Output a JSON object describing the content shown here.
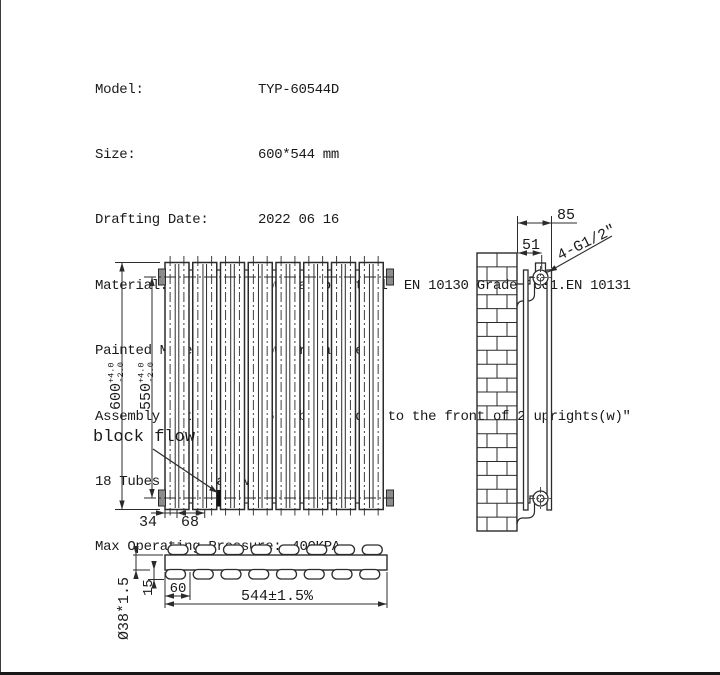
{
  "page": {
    "background": "#ffffff",
    "line_color": "#2b2b2b",
    "boss_color": "#8c8c8c",
    "plug_color": "#111111"
  },
  "specs": {
    "rows": [
      {
        "label": "Model:",
        "value": "TYP-60544D"
      },
      {
        "label": "Size:",
        "value": "600*544 mm"
      },
      {
        "label": "Drafting Date:",
        "value": "2022 06 16"
      },
      {
        "label": "Material:",
        "value": "low Carbon Steel  EN 10130 Grade Dc01.EN 10131"
      },
      {
        "label": "Painted Models:",
        "value": "Powder painted"
      },
      {
        "label": "Assembly Method:",
        "value": "16 Tubes Welded to the front of 2 uprights(w)″"
      }
    ],
    "continuation": "18 Tubes in Total(w)″",
    "pressure_label": "Max Operating Pressure:",
    "pressure_value": "400KPA"
  },
  "front_view": {
    "height_dim": {
      "value": "600",
      "tol_plus": "+4.0",
      "tol_minus": "-2.0"
    },
    "center_dim": {
      "value": "550",
      "tol_plus": "+4.0",
      "tol_minus": "-2.0"
    },
    "spacing_dim": "34",
    "pitch_dim": "68",
    "annotation": "block flow"
  },
  "side_view": {
    "depth_dim": "85",
    "center_depth_dim": "51",
    "connection_label": "4-G1/2\""
  },
  "top_view": {
    "tube_dim": "Ø38*1.5",
    "offset_dim": "15",
    "end_dim": "60",
    "width_dim": "544±1.5%"
  }
}
